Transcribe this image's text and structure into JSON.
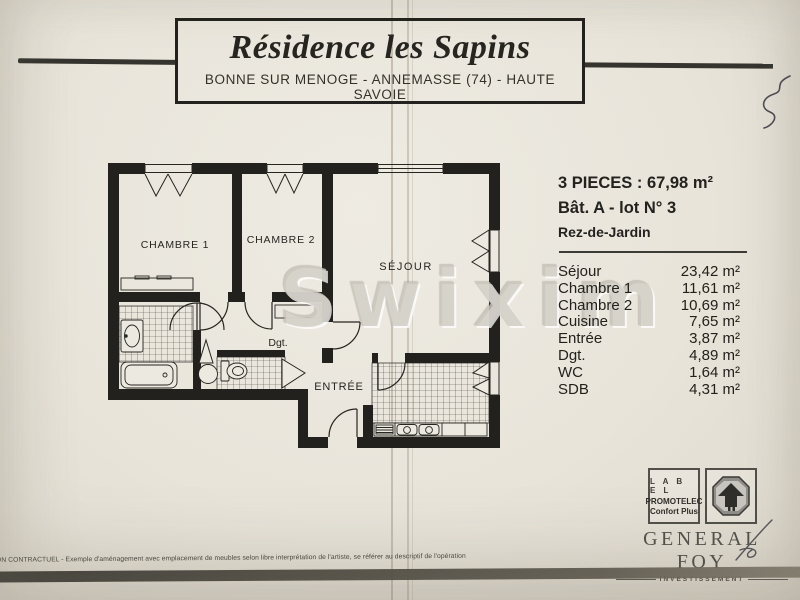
{
  "page": {
    "title": "Résidence les Sapins",
    "subtitle": "BONNE SUR MENOGE - ANNEMASSE (74) - HAUTE SAVOIE"
  },
  "info": {
    "type_line": "3 PIECES : 67,98 m²",
    "lot_line": "Bât. A - lot N° 3",
    "level_line": "Rez-de-Jardin",
    "rooms": [
      {
        "name": "Séjour",
        "area": "23,42 m²"
      },
      {
        "name": "Chambre 1",
        "area": "11,61 m²"
      },
      {
        "name": "Chambre 2",
        "area": "10,69 m²"
      },
      {
        "name": "Cuisine",
        "area": "7,65 m²"
      },
      {
        "name": "Entrée",
        "area": "3,87 m²"
      },
      {
        "name": "Dgt.",
        "area": "4,89 m²"
      },
      {
        "name": "WC",
        "area": "1,64 m²"
      },
      {
        "name": "SDB",
        "area": "4,31 m²"
      }
    ]
  },
  "plan": {
    "labels": {
      "chambre1": "CHAMBRE 1",
      "chambre2": "CHAMBRE 2",
      "sejour": "SÉJOUR",
      "dgt": "Dgt.",
      "entree": "ENTRÉE"
    }
  },
  "watermark": {
    "text": "Swixim"
  },
  "promotelec": {
    "line1": "L A B E L",
    "line2": "PROMOTELEC",
    "line3": "Confort Plus"
  },
  "general_foy": {
    "name": "GENERAL FOY",
    "sub": "INVESTISSEMENT"
  },
  "footer": {
    "disclaimer": "ON CONTRACTUEL - Exemple d'aménagement avec emplacement de meubles selon libre interprétation de l'artiste, se référer au descriptif de l'opération"
  },
  "colors": {
    "paper": "#e8e4da",
    "ink": "#23221e",
    "watermark": "#cec9c1"
  }
}
